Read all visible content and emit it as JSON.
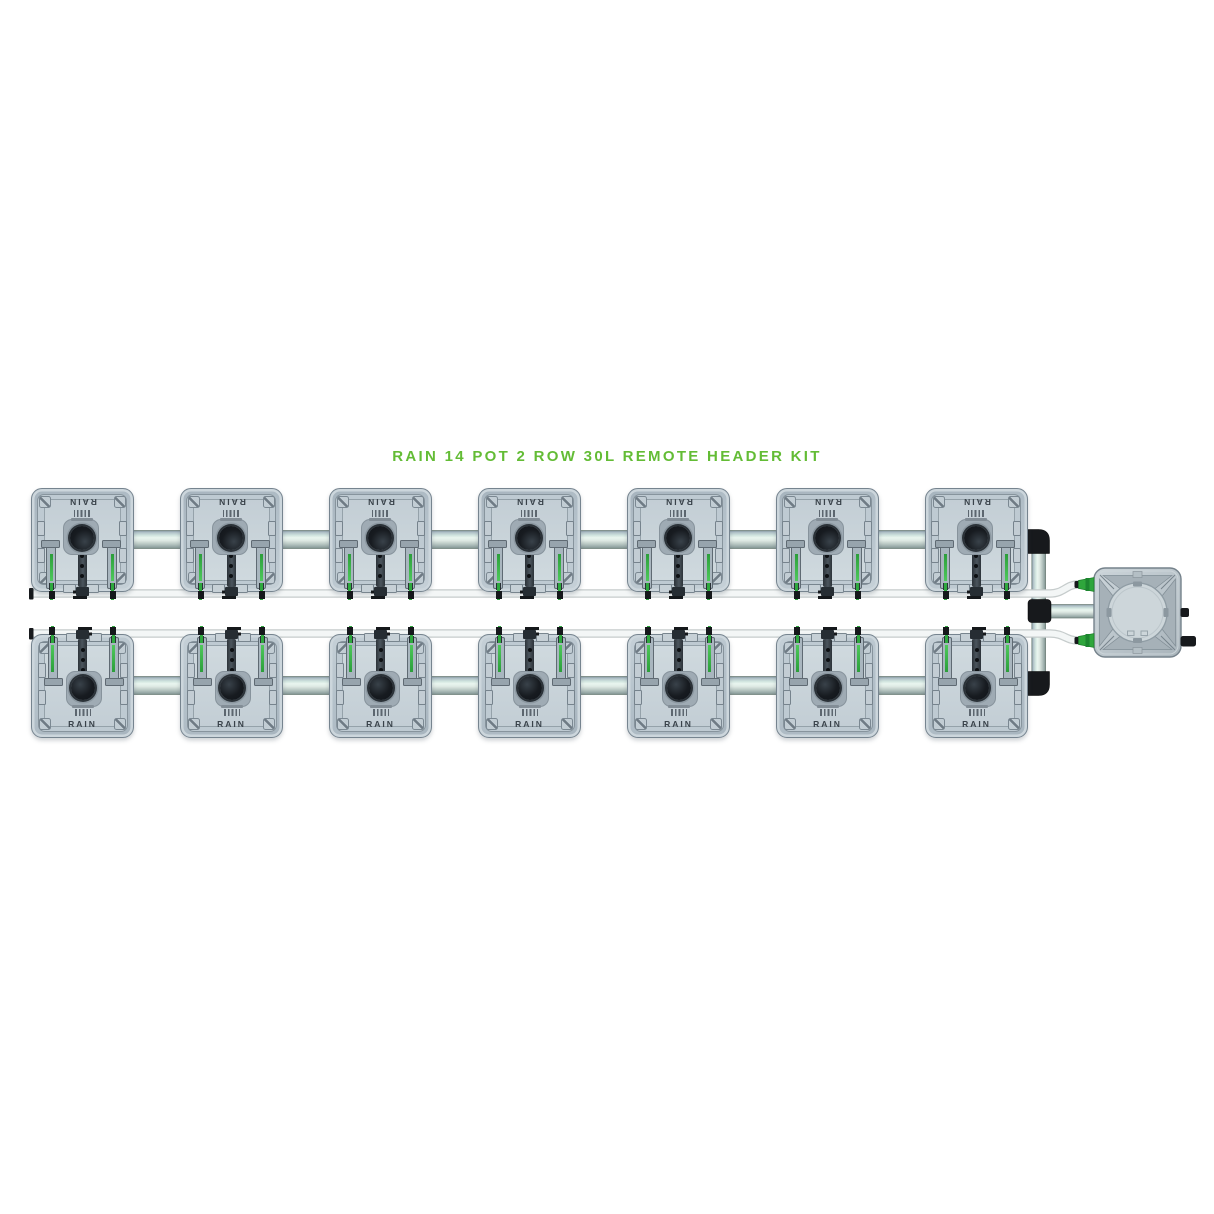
{
  "title": {
    "text": "RAIN 14 POT 2 ROW 30L REMOTE HEADER KIT"
  },
  "kit": {
    "pot_label": "RAIN",
    "pot_count": 14,
    "rows": 2,
    "pots_per_row": 7
  },
  "components": {
    "header_tank": "remote header tank with round pump lid",
    "manifold": "black elbow and tee manifold joining both rows",
    "feed_tubes": "two white feed tubes running to header inlets",
    "row_pipes": "grey interconnect pipes between pots"
  },
  "colors": {
    "title_green": "#63bc35",
    "clip_green": "#2fa63c",
    "pipe_highlight": "#e9f5ef",
    "pot_body_gray": "#b7c3cc",
    "fitting_black": "#17191c",
    "tube_white": "#f3f6f6",
    "background": "#ffffff"
  }
}
